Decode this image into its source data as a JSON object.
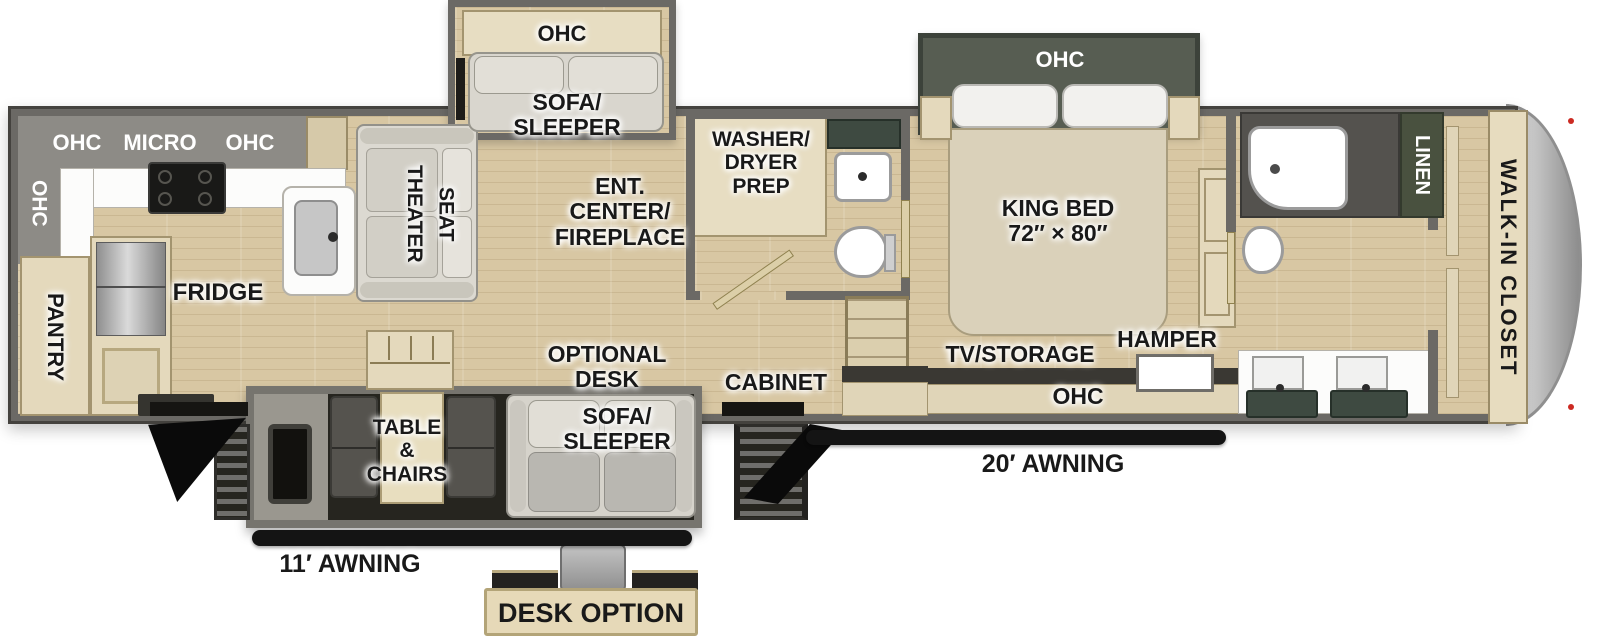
{
  "meta": {
    "type": "rv-floorplan-diagram"
  },
  "colors": {
    "floor_wood": "#d8c7a3",
    "wall_gray": "#6b6965",
    "cabinet_tan": "#e4d9bc",
    "overhead_gray": "#8d8b86",
    "slide_green": "#575d52",
    "counter_green": "#3e4a41",
    "awning_black": "#141414",
    "marker_red": "#cc2a22"
  },
  "labels": {
    "kitchen": {
      "ohc_side": "OHC",
      "ohc_top_left": "OHC",
      "micro": "MICRO",
      "ohc_top_right": "OHC",
      "pantry": "PANTRY",
      "fridge": "FRIDGE"
    },
    "living": {
      "theater_seat": "THEATER\nSEAT",
      "entertainment": "ENT.\nCENTER/\nFIREPLACE",
      "sofa_slide_ohc": "OHC",
      "sofa_slide": "SOFA/\nSLEEPER"
    },
    "bath_mid": {
      "washer_dryer": "WASHER/\nDRYER\nPREP"
    },
    "bedroom": {
      "ohc_slide": "OHC",
      "king_bed": "KING BED\n72″ × 80″",
      "tv_storage": "TV/STORAGE",
      "hamper": "HAMPER",
      "ohc_foot": "OHC"
    },
    "bath_front": {
      "linen": "LINEN"
    },
    "front": {
      "walk_in_closet": "WALK-IN CLOSET"
    },
    "door_side": {
      "cabinet": "CABINET",
      "table_chairs": "TABLE\n&\nCHAIRS",
      "optional_desk": "OPTIONAL\nDESK",
      "sofa_sleeper": "SOFA/\nSLEEPER",
      "awning_11": "11′ AWNING",
      "awning_20": "20′ AWNING"
    },
    "inset": {
      "desk_option": "DESK OPTION"
    }
  }
}
